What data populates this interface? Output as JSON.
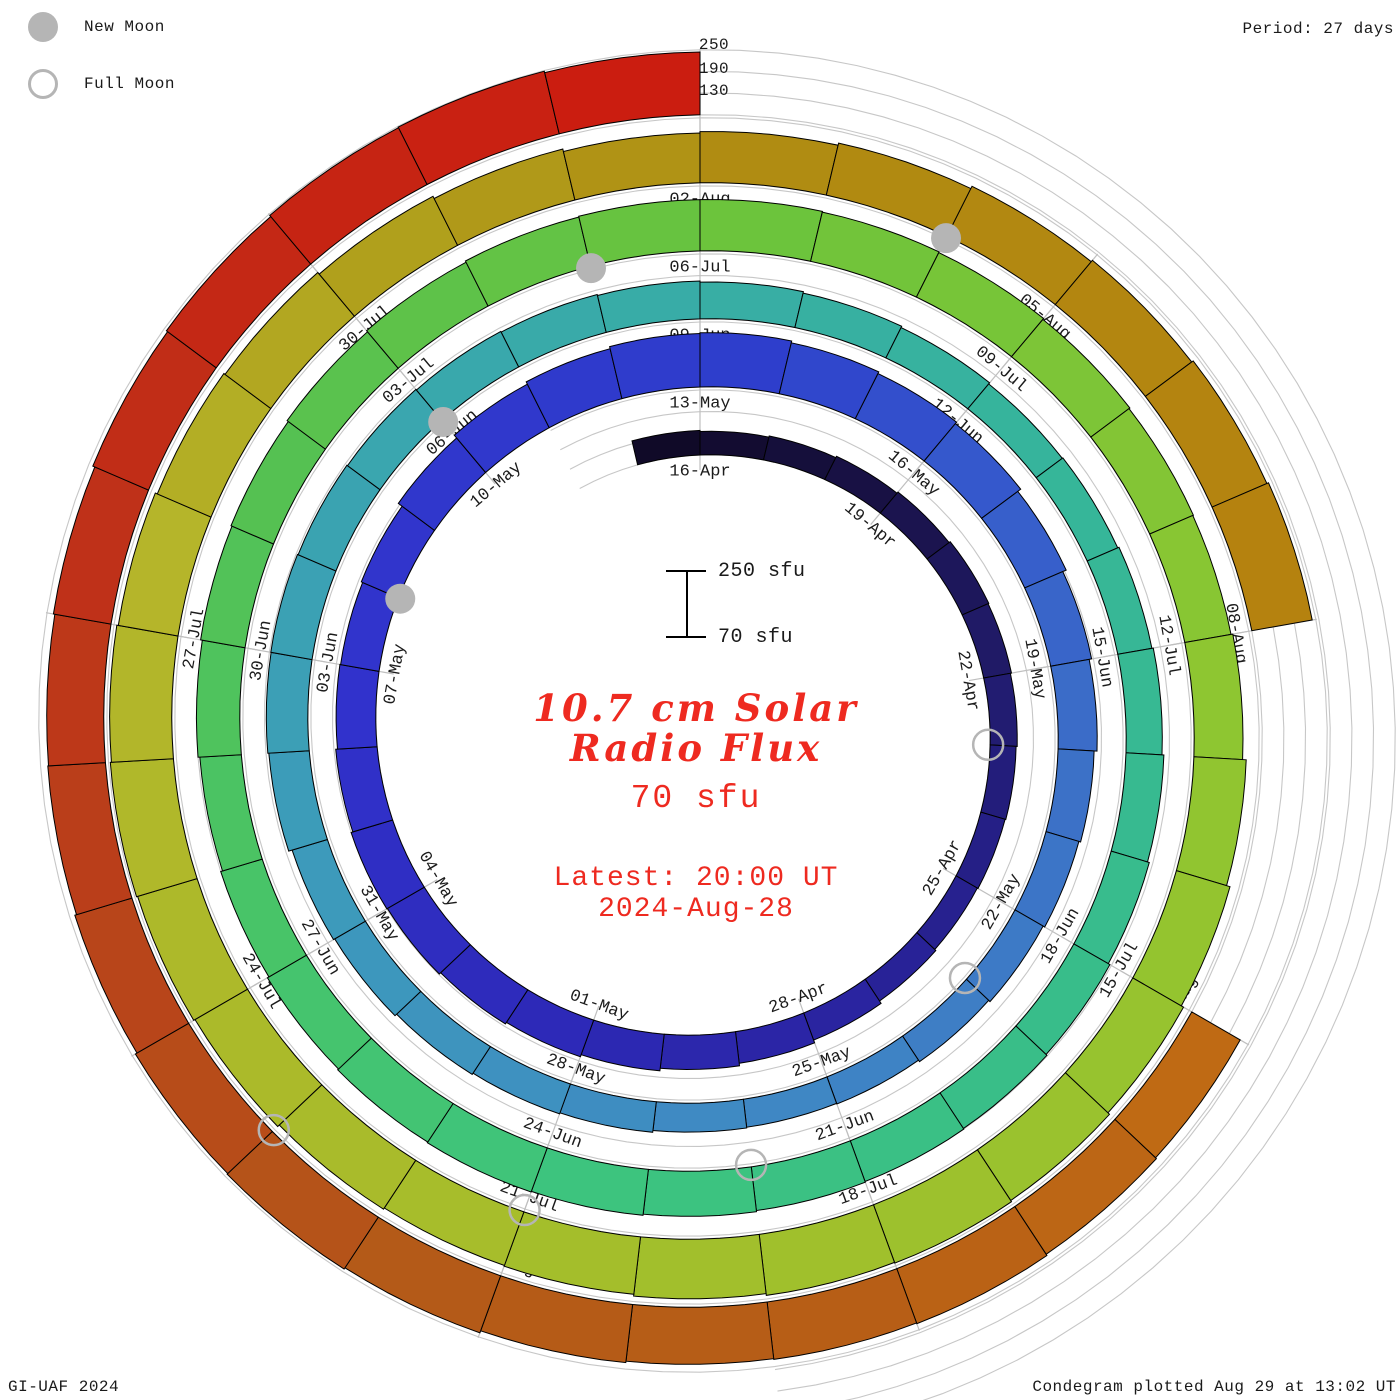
{
  "legend": {
    "new_moon_label": "New Moon",
    "full_moon_label": "Full Moon"
  },
  "header": {
    "period_label": "Period: 27 days"
  },
  "radial_scale": {
    "labels": [
      "250",
      "190",
      "130"
    ]
  },
  "scale_bar": {
    "top_label": "250 sfu",
    "bottom_label": "70 sfu"
  },
  "center_text": {
    "title_line1": "10.7 cm Solar",
    "title_line2": "Radio Flux",
    "value": "70 sfu",
    "latest_line1": "Latest: 20:00 UT",
    "latest_line2": "2024-Aug-28"
  },
  "footer": {
    "left": "GI-UAF 2024",
    "right": "Condegram plotted Aug 29 at 13:02 UT"
  },
  "palette": {
    "moon_gray": "#b5b5b5",
    "grid_arc_gray": "#c7c7c7",
    "radial_line_gray": "#bfbfbf",
    "bar_outline": "#000000",
    "label_color": "#1b1b1b",
    "text_red": "#ee2a20"
  },
  "chart_data": {
    "type": "spiral-bar-condegram",
    "title": "10.7 cm Solar Radio Flux",
    "unit": "sfu",
    "days_per_rotation": 27,
    "date_tick_step_days": 3,
    "radial_axis": {
      "min": 70,
      "max": 250,
      "gridlines": [
        70,
        130,
        190,
        250
      ],
      "top_tick_labels": [
        250,
        190,
        130
      ]
    },
    "first_tick_label": "16-Apr",
    "last_tick_label": "23-Aug",
    "dates": [
      "15-Apr",
      "16-Apr",
      "17-Apr",
      "18-Apr",
      "19-Apr",
      "20-Apr",
      "21-Apr",
      "22-Apr",
      "23-Apr",
      "24-Apr",
      "25-Apr",
      "26-Apr",
      "27-Apr",
      "28-Apr",
      "29-Apr",
      "30-Apr",
      "01-May",
      "02-May",
      "03-May",
      "04-May",
      "05-May",
      "06-May",
      "07-May",
      "08-May",
      "09-May",
      "10-May",
      "11-May",
      "12-May",
      "13-May",
      "14-May",
      "15-May",
      "16-May",
      "17-May",
      "18-May",
      "19-May",
      "20-May",
      "21-May",
      "22-May",
      "23-May",
      "24-May",
      "25-May",
      "26-May",
      "27-May",
      "28-May",
      "29-May",
      "30-May",
      "31-May",
      "01-Jun",
      "02-Jun",
      "03-Jun",
      "04-Jun",
      "05-Jun",
      "06-Jun",
      "07-Jun",
      "08-Jun",
      "09-Jun",
      "10-Jun",
      "11-Jun",
      "12-Jun",
      "13-Jun",
      "14-Jun",
      "15-Jun",
      "16-Jun",
      "17-Jun",
      "18-Jun",
      "19-Jun",
      "20-Jun",
      "21-Jun",
      "22-Jun",
      "23-Jun",
      "24-Jun",
      "25-Jun",
      "26-Jun",
      "27-Jun",
      "28-Jun",
      "29-Jun",
      "30-Jun",
      "01-Jul",
      "02-Jul",
      "03-Jul",
      "04-Jul",
      "05-Jul",
      "06-Jul",
      "07-Jul",
      "08-Jul",
      "09-Jul",
      "10-Jul",
      "11-Jul",
      "12-Jul",
      "13-Jul",
      "14-Jul",
      "15-Jul",
      "16-Jul",
      "17-Jul",
      "18-Jul",
      "19-Jul",
      "20-Jul",
      "21-Jul",
      "22-Jul",
      "23-Jul",
      "24-Jul",
      "25-Jul",
      "26-Jul",
      "27-Jul",
      "28-Jul",
      "29-Jul",
      "30-Jul",
      "31-Jul",
      "01-Aug",
      "02-Aug",
      "03-Aug",
      "04-Aug",
      "05-Aug",
      "06-Aug",
      "07-Aug",
      "08-Aug",
      "09-Aug",
      "10-Aug",
      "11-Aug",
      "12-Aug",
      "13-Aug",
      "14-Aug",
      "15-Aug",
      "16-Aug",
      "17-Aug",
      "18-Aug",
      "19-Aug",
      "20-Aug",
      "21-Aug",
      "22-Aug",
      "23-Aug",
      "24-Aug",
      "25-Aug",
      "26-Aug",
      "27-Aug",
      "28-Aug"
    ],
    "values": [
      138,
      135,
      138,
      142,
      146,
      150,
      148,
      145,
      142,
      140,
      138,
      142,
      150,
      158,
      165,
      172,
      178,
      183,
      188,
      190,
      185,
      180,
      178,
      182,
      195,
      205,
      212,
      218,
      220,
      215,
      210,
      205,
      195,
      185,
      178,
      170,
      165,
      160,
      155,
      150,
      148,
      150,
      155,
      158,
      162,
      168,
      172,
      182,
      185,
      186,
      184,
      182,
      180,
      178,
      175,
      172,
      168,
      164,
      160,
      162,
      166,
      170,
      175,
      180,
      185,
      188,
      190,
      192,
      195,
      198,
      200,
      198,
      195,
      190,
      185,
      190,
      195,
      198,
      202,
      206,
      210,
      212,
      212,
      210,
      208,
      205,
      202,
      200,
      205,
      215,
      225,
      232,
      238,
      242,
      240,
      235,
      230,
      228,
      232,
      238,
      242,
      245,
      242,
      238,
      232,
      228,
      222,
      215,
      208,
      212,
      218,
      225,
      230,
      235,
      240,
      null,
      null,
      null,
      225,
      228,
      232,
      230,
      228,
      232,
      238,
      242,
      240,
      235,
      230,
      228,
      232,
      238,
      242,
      246,
      248,
      244
    ],
    "missing_dates": [
      "08-Aug",
      "09-Aug",
      "10-Aug"
    ],
    "new_moon_dates": [
      "08-May",
      "06-Jun",
      "05-Jul",
      "04-Aug"
    ],
    "full_moon_dates": [
      "23-Apr",
      "23-May",
      "22-Jun",
      "21-Jul",
      "19-Aug"
    ],
    "latest": {
      "time": "20:00 UT",
      "date": "2024-Aug-28"
    },
    "colormap_stops": [
      [
        0,
        "#100a28"
      ],
      [
        3,
        "#181144"
      ],
      [
        6,
        "#201a66"
      ],
      [
        9,
        "#251f86"
      ],
      [
        12,
        "#2a24a0"
      ],
      [
        16,
        "#2d29b8"
      ],
      [
        21,
        "#3132cc"
      ],
      [
        25,
        "#3038cc"
      ],
      [
        28,
        "#2e3ecc"
      ],
      [
        31,
        "#3558cc"
      ],
      [
        34,
        "#3b6cc8"
      ],
      [
        40,
        "#3f87c4"
      ],
      [
        46,
        "#3d9abb"
      ],
      [
        52,
        "#39a8ac"
      ],
      [
        58,
        "#36b49c"
      ],
      [
        64,
        "#38bd8a"
      ],
      [
        69,
        "#3dc47e"
      ],
      [
        73,
        "#48c468"
      ],
      [
        77,
        "#55c152"
      ],
      [
        82,
        "#6cc43c"
      ],
      [
        88,
        "#8ec631"
      ],
      [
        94,
        "#a0c02c"
      ],
      [
        100,
        "#adb92a"
      ],
      [
        103,
        "#b5b52a"
      ],
      [
        106,
        "#b0a01c"
      ],
      [
        109,
        "#b08c12"
      ],
      [
        114,
        "#b5820f"
      ],
      [
        118,
        "#bf6a14"
      ],
      [
        121,
        "#b75e16"
      ],
      [
        124,
        "#b45a18"
      ],
      [
        127,
        "#b8451a"
      ],
      [
        130,
        "#bf3119"
      ],
      [
        133,
        "#c62413"
      ],
      [
        135,
        "#cb1d10"
      ]
    ]
  }
}
